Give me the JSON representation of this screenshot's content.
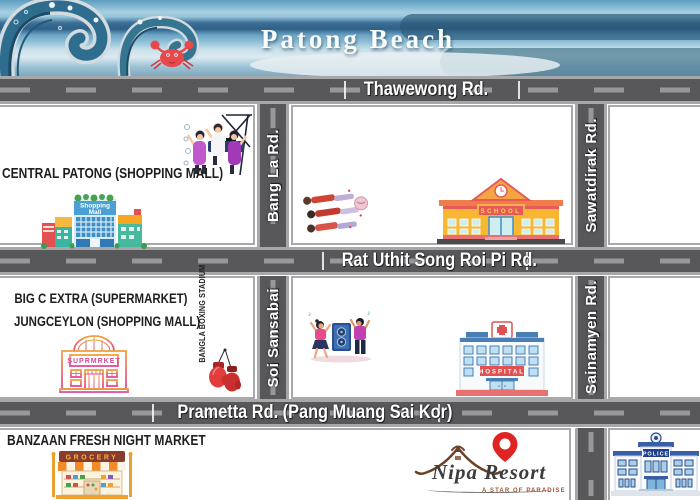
{
  "banner": {
    "title": "Patong Beach"
  },
  "roads": {
    "horizontal": [
      {
        "id": "thawewong",
        "label": "Thawewong Rd."
      },
      {
        "id": "rat-uthit",
        "label": "Rat Uthit Song Roi Pi Rd."
      },
      {
        "id": "prametta",
        "label": "Prametta Rd. (Pang Muang Sai Kor)"
      }
    ],
    "vertical": [
      {
        "id": "bang-la",
        "label": "Bang La Rd."
      },
      {
        "id": "sawatdirak",
        "label": "Sawatdirak Rd."
      },
      {
        "id": "soi-sansabai",
        "label": "Soi Sansabai"
      },
      {
        "id": "sainamyen",
        "label": "Sainamyen Rd."
      }
    ]
  },
  "landmarks": {
    "central_patong": "CENTRAL PATONG (SHOPPING MALL)",
    "big_c_extra": "BIG C EXTRA (SUPERMARKET)",
    "jungceylon": "JUNGCEYLON (SHOPPING MALL)",
    "bangla_boxing_stadium": "BANGLA BOXING STADIUM",
    "banzaan_night_market": "BANZAAN FRESH NIGHT MARKET"
  },
  "building_signs": {
    "mall_line1": "Shopping",
    "mall_line2": "Mall",
    "school": "SCHOOL",
    "supermarket": "SUPRMRKET",
    "hospital": "HOSPITAL",
    "grocery": "GROCERY",
    "police": "POLICE"
  },
  "nipa_resort": {
    "name": "Nipa Resort",
    "tagline": "A STAR OF PARADISE"
  },
  "decor": {
    "music_note": "♪"
  },
  "colors": {
    "road_fill": "#58585a",
    "road_dash": "#98989c",
    "road_border": "#a6a7a9",
    "block_border": "#a9a9ab",
    "crab_red": "#e8474b",
    "pin_red": "#e02424",
    "wave_teal": "#2f6d8f",
    "label_white": "#ffffff",
    "landmark_text": "#1f1f1f"
  }
}
